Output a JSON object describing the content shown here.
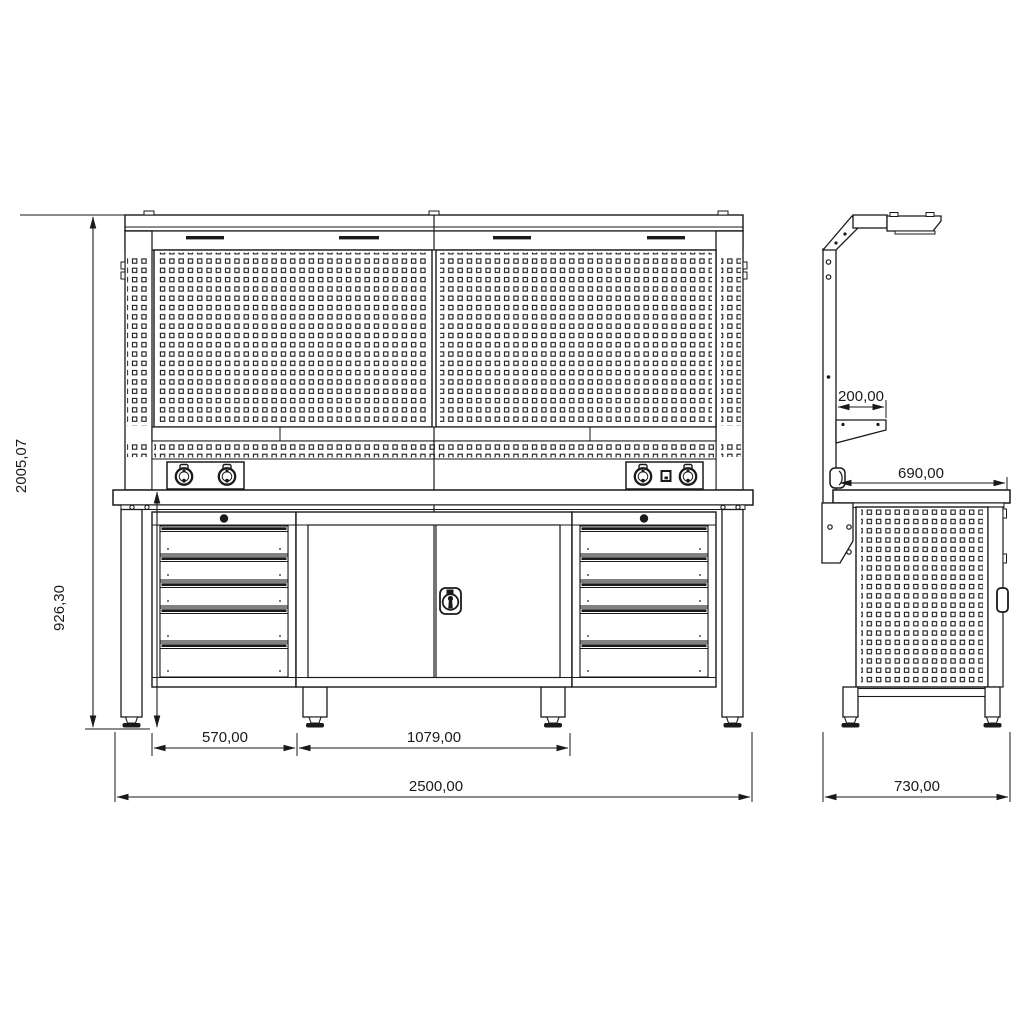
{
  "drawing": {
    "title": "workbench-technical-drawing",
    "front_view": {
      "dimensions": {
        "total_height": "2005,07",
        "worktop_height": "926,30",
        "drawer_unit_width": "570,00",
        "center_cabinet_width": "1079,00",
        "total_width": "2500,00"
      },
      "components": {
        "drawers_left": 5,
        "drawers_right": 5,
        "doors_center": 2,
        "sockets_left_panel": 2,
        "sockets_right_panel": 2,
        "switches_right_panel": 1,
        "adjustable_feet": 4
      }
    },
    "side_view": {
      "dimensions": {
        "light_arm_depth": "200,00",
        "worktop_depth": "690,00",
        "total_depth": "730,00"
      },
      "components": {
        "adjustable_feet": 2
      }
    },
    "icons": [
      "pegboard-hole-pattern",
      "power-socket-icon",
      "power-switch-icon",
      "door-lock-icon",
      "drawer-handle-icon",
      "adjustable-foot-icon",
      "task-light-icon"
    ],
    "colors": {
      "line": "#1a1a1a",
      "background": "#ffffff"
    }
  }
}
